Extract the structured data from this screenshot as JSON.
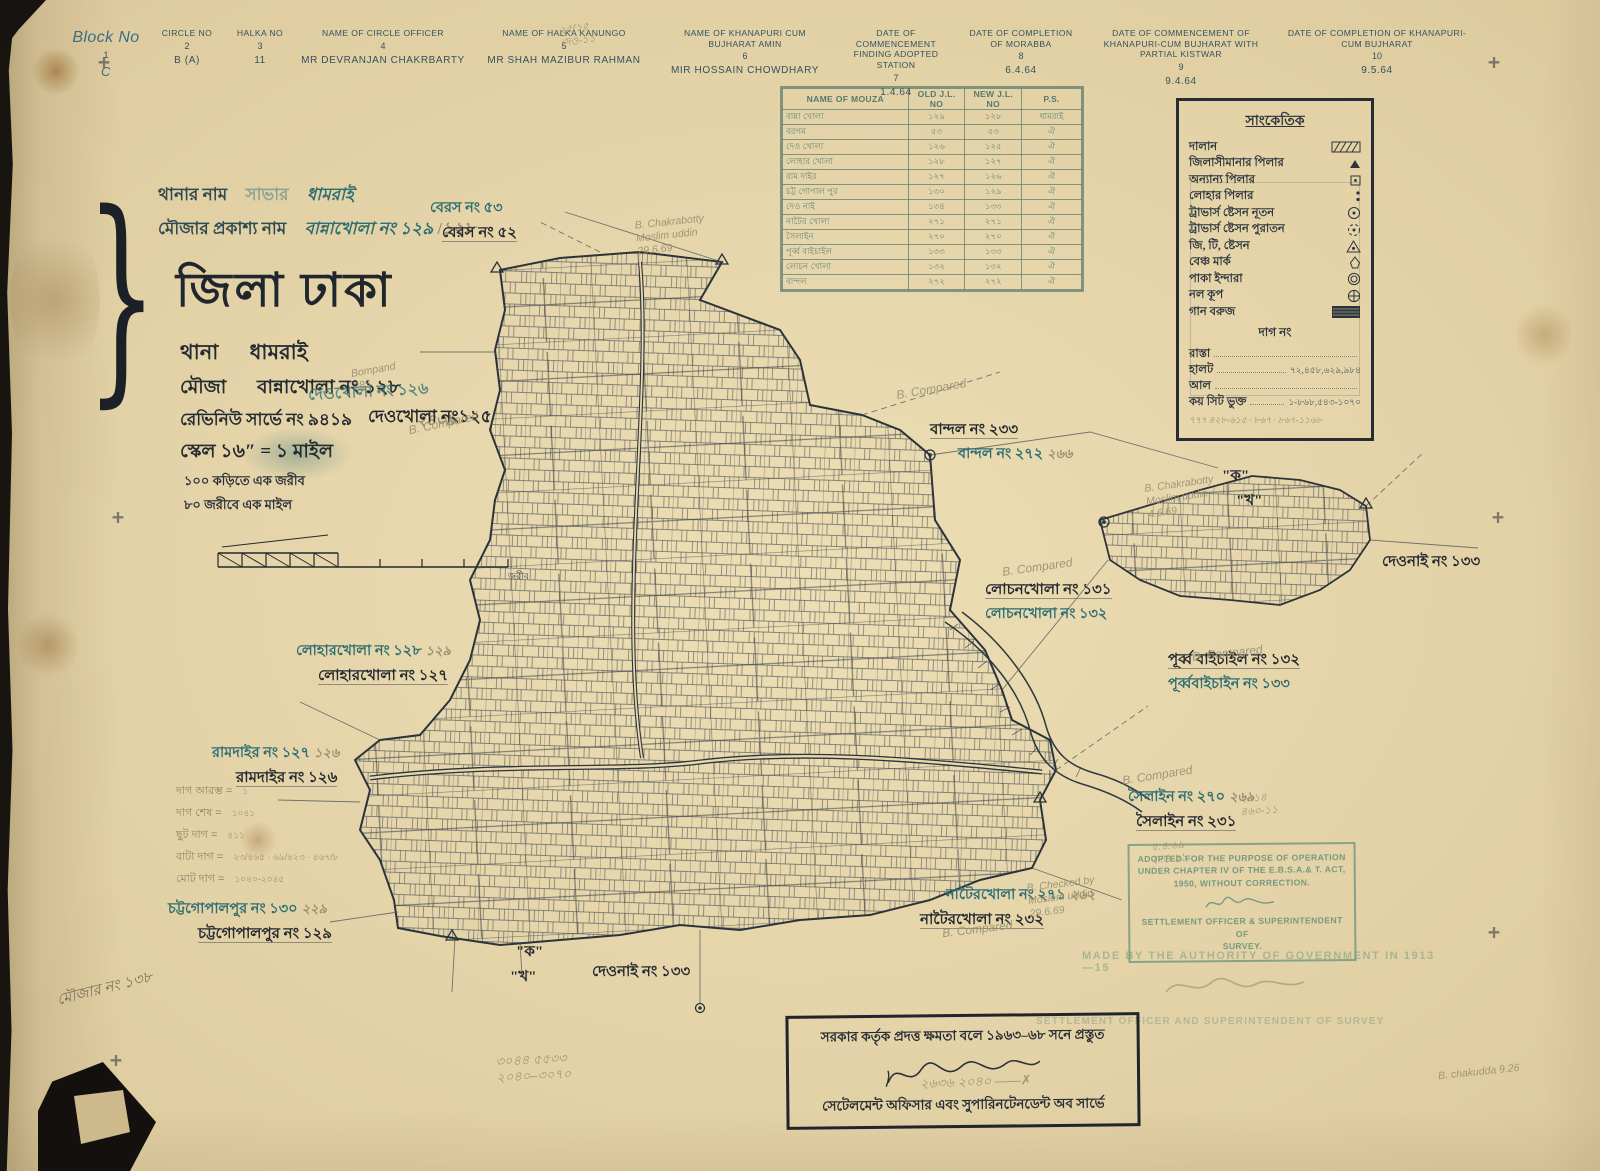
{
  "colors": {
    "paper": "#e9d8ab",
    "ink": "#2c343c",
    "teal": "#2f6e72",
    "pencil": "#99906f",
    "stamp_green": "#76997f"
  },
  "header_row": {
    "columns": [
      {
        "label": "Block No",
        "num": "1",
        "value": "C"
      },
      {
        "label": "Circle No",
        "num": "2",
        "value": "B (A)"
      },
      {
        "label": "Halka No",
        "num": "3",
        "value": "11"
      },
      {
        "label": "Name of Circle Officer",
        "num": "4",
        "value": "MR DEVRANJAN CHAKRBARTY"
      },
      {
        "label": "Name of Halka Kanungo",
        "num": "5",
        "value": "MR SHAH MAZIBUR RAHMAN"
      },
      {
        "label": "Name of Khanapuri cum Bujharat Amin",
        "num": "6",
        "value": "MIR HOSSAIN CHOWDHARY"
      },
      {
        "label": "Date of Commencement Finding Adopted Station",
        "num": "7",
        "value": "1.4.64"
      },
      {
        "label": "Date of Completion of Morabba",
        "num": "8",
        "value": "6.4.64"
      },
      {
        "label": "Date of Commencement of Khanapuri-cum Bujharat with Partial Kistwar",
        "num": "9",
        "value": "9.4.64"
      },
      {
        "label": "Date of Completion of Khanapuri-cum Bujharat",
        "num": "10",
        "value": "9.5.64"
      }
    ]
  },
  "mouza_table": {
    "headers": {
      "name": "NAME OF MOUZA",
      "old": "OLD J.L. NO",
      "new": "NEW J.L. NO",
      "ps": "P.S."
    },
    "rows": [
      {
        "name": "বান্না খোলা",
        "old": "১২৯",
        "new": "১২৮",
        "ps": "ধামরাই"
      },
      {
        "name": "বরগম",
        "old": "৫৩",
        "new": "৫৩",
        "ps": "ঐ"
      },
      {
        "name": "দেও খোলা",
        "old": "১২৬",
        "new": "১২৫",
        "ps": "ঐ"
      },
      {
        "name": "লোহার খোলা",
        "old": "১২৮",
        "new": "১২৭",
        "ps": "ঐ"
      },
      {
        "name": "রাম দাইর",
        "old": "১২৭",
        "new": "১২৬",
        "ps": "ঐ"
      },
      {
        "name": "চট্ট গোপাল পুর",
        "old": "১৩০",
        "new": "১২৯",
        "ps": "ঐ"
      },
      {
        "name": "দেও নাই",
        "old": "১৩৪",
        "new": "১৩৩",
        "ps": "ঐ"
      },
      {
        "name": "নাটৈর খোলা",
        "old": "২৭১",
        "new": "২৭১",
        "ps": "ঐ"
      },
      {
        "name": "সৈলাইন",
        "old": "২৭০",
        "new": "২৭০",
        "ps": "ঐ"
      },
      {
        "name": "পূর্ব্ব বাইচাইল",
        "old": "১৩৩",
        "new": "১৩৩",
        "ps": "ঐ"
      },
      {
        "name": "লোচন খোলা",
        "old": "১৩২",
        "new": "১৩২",
        "ps": "ঐ"
      },
      {
        "name": "বান্দল",
        "old": "২৭২",
        "new": "২৭২",
        "ps": "ঐ"
      }
    ]
  },
  "legend": {
    "title": "সাংকেতিক",
    "items": [
      {
        "label": "দালান",
        "symbol": "building-hatch"
      },
      {
        "label": "জিলাসীমানার পিলার",
        "symbol": "small-triangle"
      },
      {
        "label": "অন্যান্য পিলার",
        "symbol": "square-dot"
      },
      {
        "label": "লোহার পিলার",
        "symbol": "double-dot"
      },
      {
        "label": "ট্রাভার্স ষ্টেসন নূতন",
        "symbol": "circle-dot"
      },
      {
        "label": "ট্রাভার্স ষ্টেসন পুরাতন",
        "symbol": "dashed-circle-dot"
      },
      {
        "label": "জি, টি, ষ্টেসন",
        "symbol": "triangle-dot"
      },
      {
        "label": "বেঞ্চ মার্ক",
        "symbol": "benchmark"
      },
      {
        "label": "পাকা ইন্দারা",
        "symbol": "double-circle"
      },
      {
        "label": "নল কূপ",
        "symbol": "circle-cross"
      },
      {
        "label": "গান বরুজ",
        "symbol": "dark-block"
      }
    ],
    "dag_no": "দাগ নং",
    "extras": [
      {
        "label": "রাস্তা",
        "value": ""
      },
      {
        "label": "হালট",
        "value": "৭২,৪৫৮,৬২৯,৯৮৪"
      },
      {
        "label": "আল",
        "value": ""
      },
      {
        "label": "কয় সিট ভুক্ত",
        "value": "১-৮৬৮,৫৪৩-১০৭০"
      }
    ],
    "pencil_note": "৭৭৭  ৪২৮-৬১৫ · ৮৬৭ · ৮৬৭-১১৬৮"
  },
  "title_block": {
    "thana_label": "থানার নাম",
    "thana_old": "সাভার",
    "thana_new": "ধামরাই",
    "mouza_label": "মৌজার প্রকাশ্য নাম",
    "mouza_old": "বান্নাখোলা নং ১২৯",
    "mouza_pencil": "১২৮",
    "district": "জিলা ঢাকা",
    "thana_line_label": "থানা",
    "thana_line_value": "ধামরাই",
    "mouza_line_label": "মৌজা",
    "mouza_line_value": "বান্নাখোলা নং ১২৮",
    "revenue_line": "রেভিনিউ সার্ভে নং ৯৪১৯",
    "revenue_pencil": "২৪৩৯",
    "scale_line": "স্কেল ১৬″ = ১ মাইল",
    "note1": "১০০ কড়িতে এক জরীব",
    "note2": "৮০ জরীবে এক মাইল",
    "scalebar_caption": "জরীব",
    "deokhola_blue": "দেওখোলা নং ১২৬",
    "deokhola_black": "দেওখোলা নং১২৫"
  },
  "map_labels": [
    {
      "blue": "বেরস নং ৫৩",
      "black": "বেরস নং ৫২",
      "pencil": ""
    },
    {
      "black": "বান্দল নং ২৩৩",
      "blue": "বান্দল নং ২৭২",
      "pencil": "২৬৬"
    },
    {
      "black": "লোচনখোলা নং ১৩১",
      "blue": "লোচনখোলা নং ১৩২",
      "pencil": ""
    },
    {
      "black": "পূর্ব্ব বাইচাইল নং ১৩২",
      "blue": "পূর্ব্ববাইচাইন নং ১৩৩",
      "pencil": ""
    },
    {
      "black": "দেওনাই নং ১৩৩",
      "blue": "",
      "pencil": ""
    },
    {
      "blue": "লোহারখোলা নং ১২৮",
      "pencil": "১২৯",
      "black": "লোহারখোলা নং ১২৭"
    },
    {
      "blue": "রামদাইর নং ১২৭",
      "pencil": "১২৬",
      "black": "রামদাইর নং ১২৬"
    },
    {
      "blue": "চট্টগোপালপুর নং ১৩০",
      "pencil": "২২৯",
      "black": "চট্টগোপালপুর নং ১২৯"
    },
    {
      "blue": "সৈলাইন নং ২৭০",
      "pencil": "২৬৯",
      "black": "সৈলাইন নং ২৩১"
    },
    {
      "blue": "নাটৈরখোলা নং ২৭১",
      "pencil": "২৬২",
      "black": "নাটৈরখোলা নং ২৩২"
    },
    {
      "black": "দেওনাই নং ১৩৩",
      "blue": "",
      "pencil": ""
    },
    {
      "black": "\"ক\"",
      "blue": "\"খ\"",
      "pencil": ""
    },
    {
      "black": "\"ক\"",
      "blue": "\"খ\"",
      "pencil": ""
    }
  ],
  "survey_notes": {
    "items": [
      {
        "label": "দাগ আরম্ভ =",
        "value": "১"
      },
      {
        "label": "দাগ শেষ =",
        "value": "১০৪১"
      },
      {
        "label": "ছুট দাগ =",
        "value": "৪১১"
      },
      {
        "label": "বাটা দাগ =",
        "value": "২৩/৪৬৫ · ৬৯/৪২৩ · ৪৬৭/৮"
      },
      {
        "label": "মোট দাগ =",
        "value": "১০৪০-২০৪৫"
      }
    ]
  },
  "stamps": {
    "adopted_lines": [
      "ADOPTED FOR THE PURPOSE OF OPERATION",
      "UNDER CHAPTER IV OF THE E.B.S.A.& T. ACT,",
      "1950, WITHOUT CORRECTION."
    ],
    "officer_lines": [
      "SETTLEMENT OFFICER & SUPERINTENDENT OF",
      "SURVEY."
    ],
    "made_by": "MADE BY THE AUTHORITY OF GOVERNMENT IN 1913—15",
    "officer_faint": "SETTLEMENT OFFICER AND SUPERINTENDENT OF SURVEY"
  },
  "bottom_box": {
    "line1": "সরকার কর্তৃক প্রদত্ত ক্ষমতা বলে ১৯৬৩–৬৮ সনে প্রস্তুত",
    "line2": "সেটেলমেন্ট অফিসার এবং সুপারিনটেনডেন্ট অব সার্ভে"
  },
  "pencil_notes": [
    {
      "text": "B. Compared"
    },
    {
      "text": "B. Compared"
    },
    {
      "text": "B. Compared"
    },
    {
      "text": "B. Compared"
    },
    {
      "text": "B. Compared"
    },
    {
      "text": "B. Compared"
    },
    {
      "text": "B. Chakrabotty\nMoslim uddin\n29.6.69"
    },
    {
      "text": "B. Chakrabotty\nMoslim uddin\n4.6.69"
    },
    {
      "text": "B. Checked by\nMoslem uddin\n29.6.69"
    },
    {
      "text": "২০১৪\n৪৬০-১১"
    },
    {
      "text": "৫.৪.৬৯\nদেও-১১"
    },
    {
      "text": "২৫/১৫\nদেও-১১"
    },
    {
      "text": "৩০৪৪  ৫৫৩৩\n২০৪০–৩০৭০"
    },
    {
      "text": "২৬৩৬ ২০৪০ ——✗"
    },
    {
      "text": "মৌজার নং ১৩৮"
    },
    {
      "text": "B. chakudda 9.26"
    },
    {
      "text": "Bompand\n285"
    }
  ]
}
